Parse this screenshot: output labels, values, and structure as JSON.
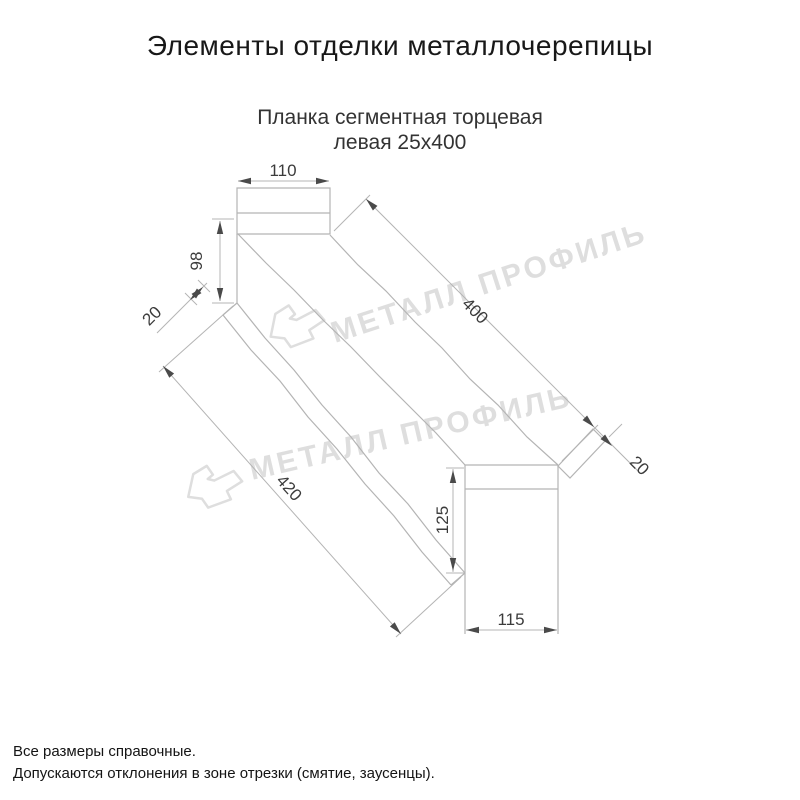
{
  "page": {
    "title": "Элементы отделки металлочерепицы",
    "subtitle_line1": "Планка сегментная торцевая",
    "subtitle_line2": "левая 25х400",
    "footer_line1": "Все размеры справочные.",
    "footer_line2": "Допускаются отклонения в зоне отрезки (смятие, заусенцы)."
  },
  "watermark": {
    "text": "МЕТАЛЛ ПРОФИЛЬ",
    "color": "#dedede"
  },
  "drawing": {
    "product": "Планка сегментная торцевая левая 25х400",
    "dimensions": {
      "top_width": "110",
      "left_height": "98",
      "left_hem": "20",
      "top_length": "400",
      "right_hem": "20",
      "bottom_length": "420",
      "right_height": "125",
      "bottom_width": "115"
    },
    "colors": {
      "line": "#b4b4b4",
      "dim_text": "#3b3b3b",
      "arrow": "#4a4a4a"
    }
  }
}
